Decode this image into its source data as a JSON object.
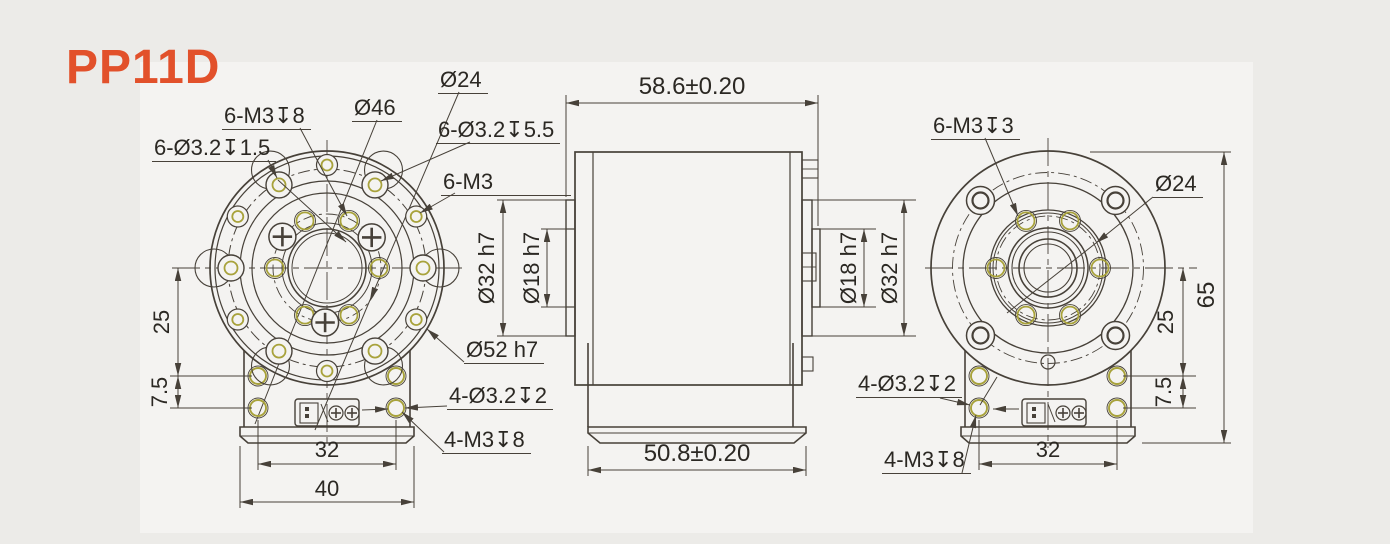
{
  "title": "PP11D",
  "colors": {
    "accent": "#e2512b",
    "line": "#474139",
    "hole_highlight": "#a8a23b",
    "panel": "#f4f3f1",
    "background": "#ecebe8"
  },
  "front_view": {
    "labels": {
      "tapped_bc": "6-M3↧8",
      "cbore_shallow": "6-Ø3.2↧1.5",
      "bolt_circle_dia": "Ø46",
      "inner_bc_dia": "Ø24",
      "cbore_deep": "6-Ø3.2↧5.5",
      "thread_outer": "6-M3",
      "pilot_dia": "Ø52 h7",
      "base_cbore": "4-Ø3.2↧2",
      "base_tapped": "4-M3↧8"
    },
    "dims": {
      "center_to_hole": "25",
      "hole_pitch_v": "7.5",
      "hole_pitch_h": "32",
      "base_width": "40"
    }
  },
  "side_view": {
    "dims": {
      "overall_depth": "58.6±0.20",
      "base_depth": "50.8±0.20",
      "left_pilot": "Ø32 h7",
      "left_bore": "Ø18 h7",
      "right_bore": "Ø18 h7",
      "right_pilot": "Ø32 h7"
    }
  },
  "rear_view": {
    "labels": {
      "tapped_bc": "6-M3↧3",
      "inner_bc_dia": "Ø24",
      "base_cbore": "4-Ø3.2↧2",
      "base_tapped": "4-M3↧8"
    },
    "dims": {
      "overall_height": "65",
      "center_to_hole": "25",
      "hole_pitch_v": "7.5",
      "hole_pitch_h": "32"
    }
  }
}
